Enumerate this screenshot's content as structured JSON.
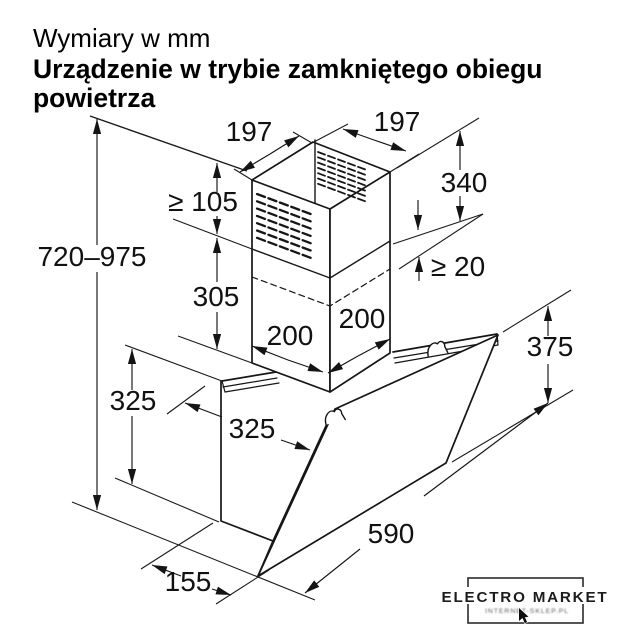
{
  "title": {
    "line1": "Wymiary w mm",
    "line2": "Urządzenie w trybie zamkniętego obiegu",
    "line3": "powietrza"
  },
  "dimensions": {
    "chimney_top_depth": "197",
    "chimney_top_width": "197",
    "upper_chimney_height": "340",
    "min_clearance_top": "≥ 105",
    "min_overlap": "≥ 20",
    "lower_chimney_height": "305",
    "chimney_base_depth": "200",
    "chimney_base_width": "200",
    "total_height_range": "720–975",
    "back_panel_height": "325",
    "glass_slant_height": "325",
    "front_panel_height": "375",
    "hood_width": "590",
    "hood_bottom_depth": "155"
  },
  "watermark": {
    "brand": "ELECTRO MARKET",
    "subtitle": "INTERNET-SKLEP.PL"
  }
}
